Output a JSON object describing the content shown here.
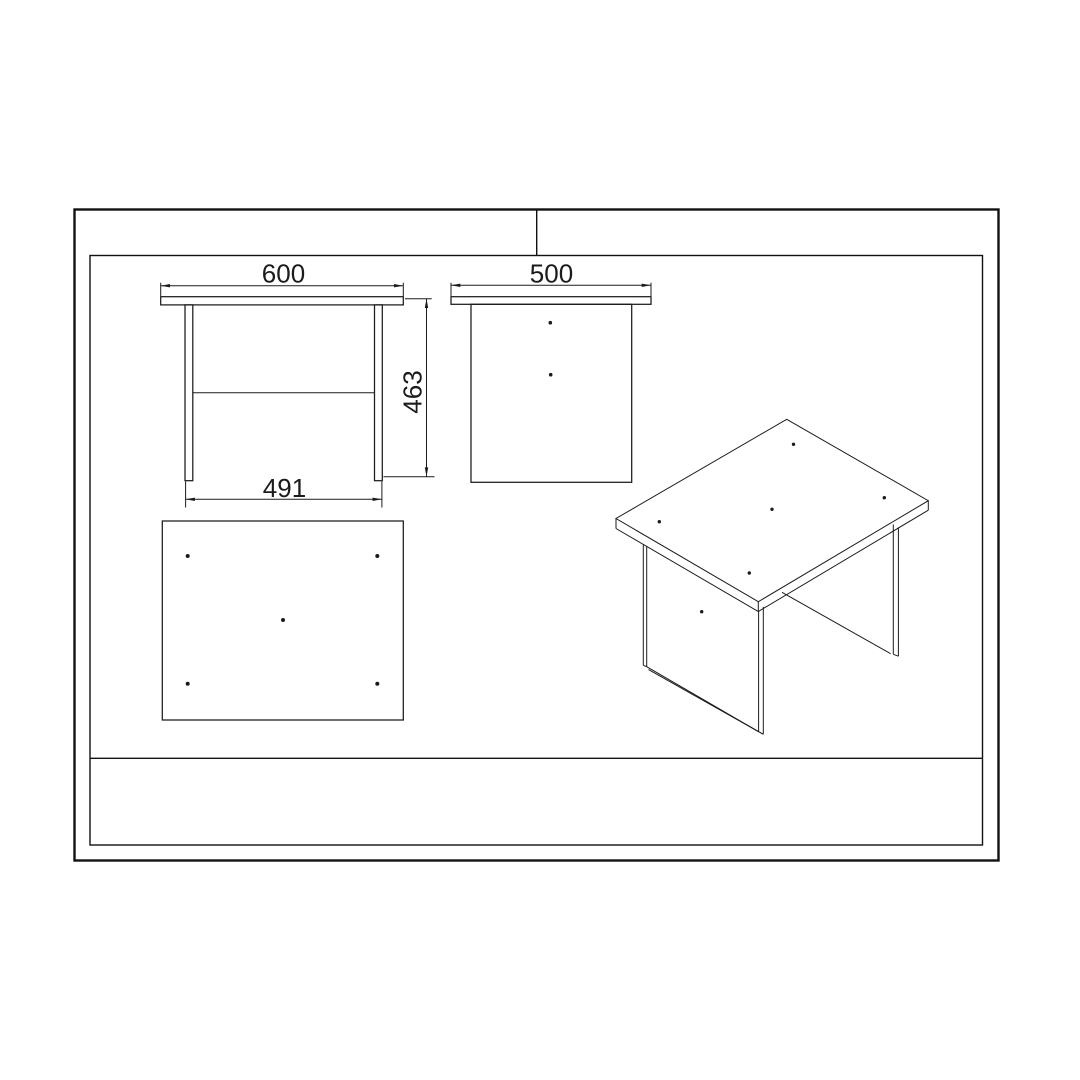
{
  "drawing": {
    "kind": "furniture technical drawing",
    "dimensions": {
      "front_width": "600",
      "side_depth": "500",
      "height": "463",
      "leg_span": "491"
    },
    "colors": {
      "line": "#1b1b1b",
      "background": "#ffffff"
    }
  }
}
